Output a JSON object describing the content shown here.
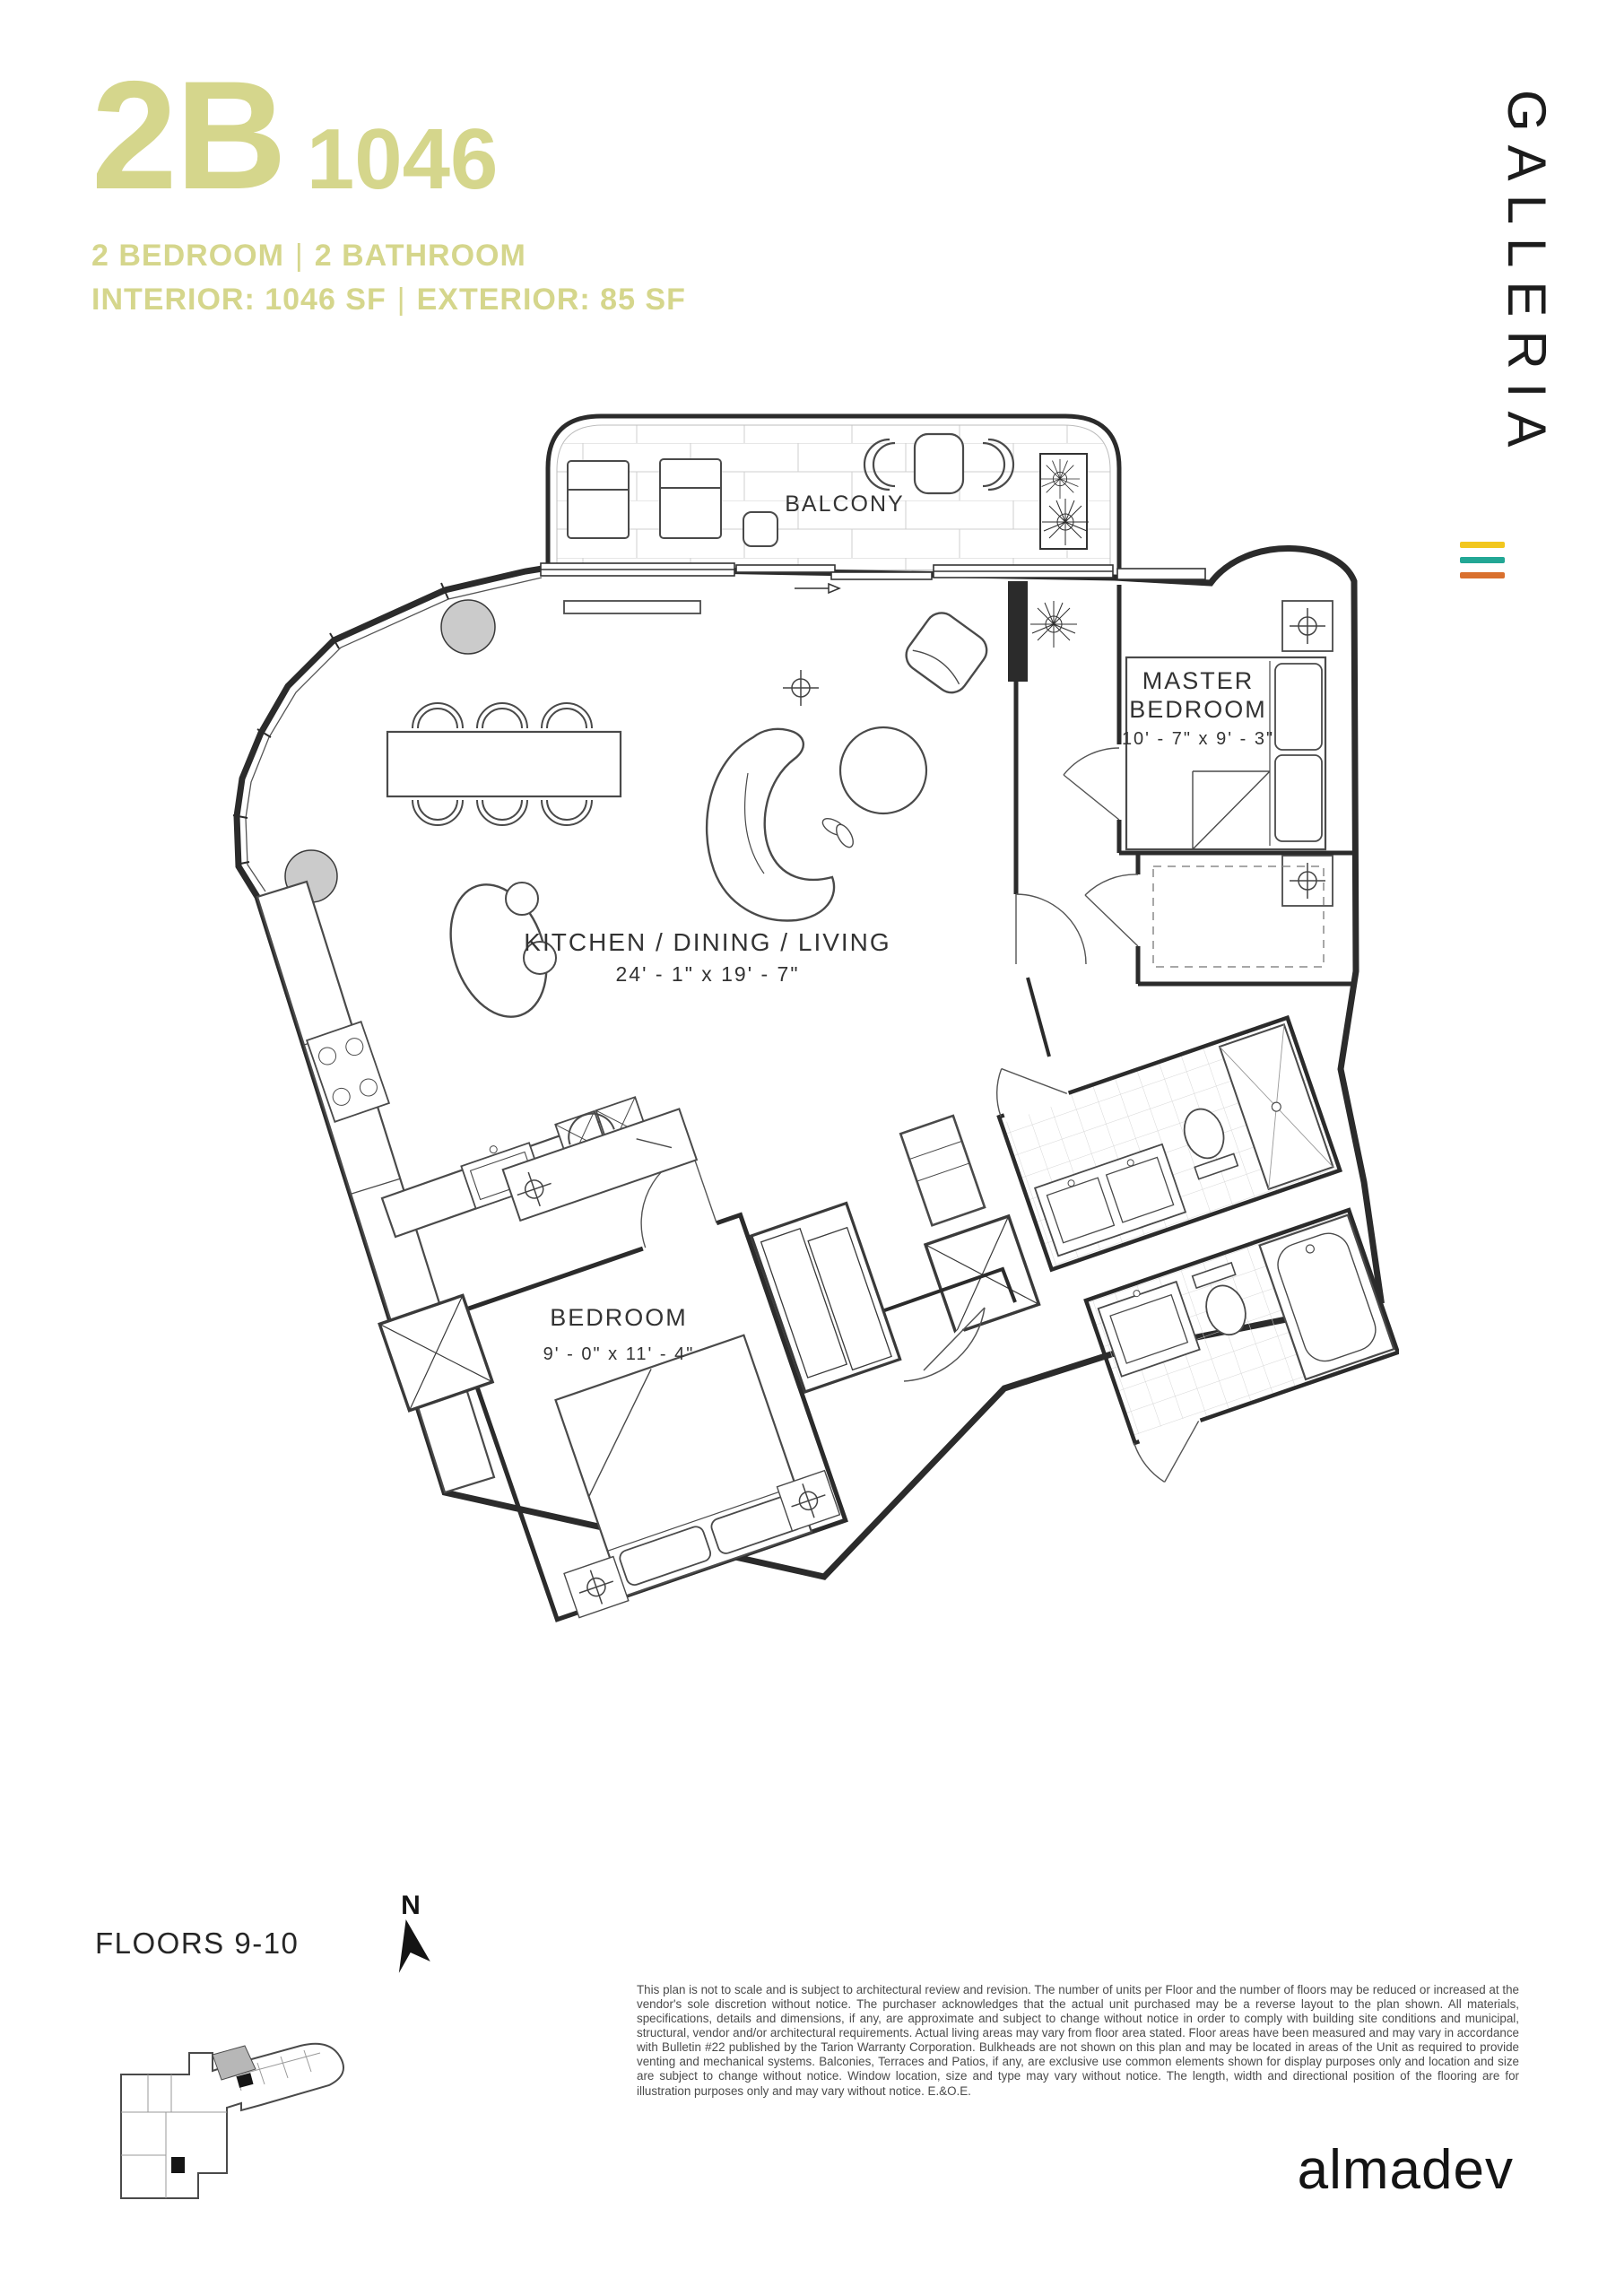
{
  "header": {
    "unit_type": "2B",
    "unit_name": "1046",
    "spec_line": {
      "left": "2 BEDROOM",
      "sep": "|",
      "right": "2 BATHROOM"
    },
    "area_line": {
      "left": "INTERIOR: 1046 SF",
      "sep": "|",
      "right": "EXTERIOR: 85 SF"
    }
  },
  "brand": {
    "logo_text": "GALLERIA",
    "stripe_colors": [
      "#F2C71E",
      "#22A795",
      "#D9702E"
    ]
  },
  "plan": {
    "balcony_label": "BALCONY",
    "master_bedroom": {
      "line1": "MASTER",
      "line2": "BEDROOM",
      "dims": "10' - 7\" x 9' - 3\""
    },
    "living": {
      "name": "KITCHEN / DINING / LIVING",
      "dims": "24' - 1\" x 19' - 7\""
    },
    "bedroom": {
      "name": "BEDROOM",
      "dims": "9' - 0\" x 11' - 4\""
    }
  },
  "footer": {
    "floors_label": "FLOORS 9-10",
    "north_label": "N",
    "disclaimer": "This plan is not to scale and is subject to architectural review and revision. The number of units per Floor and the number of floors may be reduced or increased at the vendor's sole discretion without notice. The purchaser acknowledges that the actual unit purchased may be a reverse layout to the plan shown. All materials, specifications, details and dimensions, if any, are approximate and subject to change without notice in order to comply with building site conditions and municipal, structural, vendor and/or architectural requirements. Actual living areas may vary from floor area stated. Floor areas have been measured and may vary in accordance with Bulletin #22 published by the Tarion Warranty Corporation. Bulkheads are not shown on this plan and may be located in areas of the Unit as required to provide venting and mechanical systems. Balconies, Terraces and Patios, if any, are exclusive use common elements shown for display purposes only and location and size are subject to change without notice. Window location, size and type may vary without notice. The length, width and directional position of the flooring are for illustration purposes only and may vary without notice. E.&O.E.",
    "developer": "almadev"
  },
  "colors": {
    "accent": "#D5D68C",
    "unit_highlight": "#B7B7B7"
  }
}
